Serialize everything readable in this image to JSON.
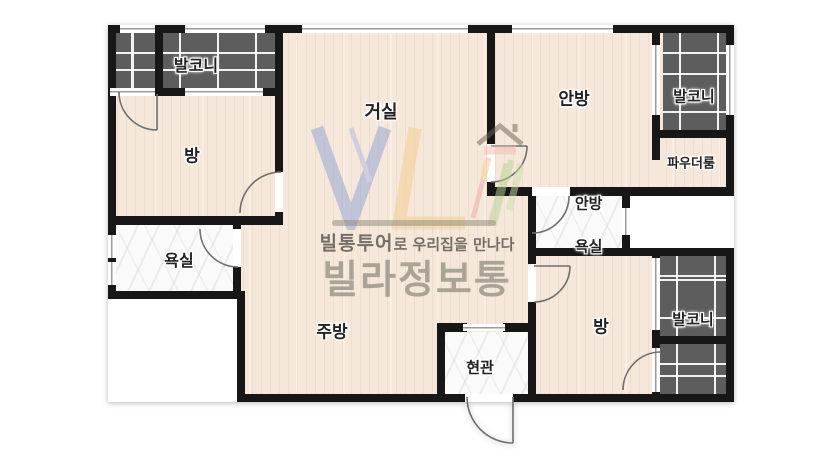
{
  "plan_title": "villa floor plan",
  "rooms": {
    "balcony_tl": "발코니",
    "room_left": "방",
    "living": "거실",
    "master": "안방",
    "balcony_tr": "발코니",
    "powder": "파우더룸",
    "master_bath_line1": "안방",
    "master_bath_line2": "욕실",
    "bath": "욕실",
    "kitchen": "주방",
    "entry": "현관",
    "room_br": "방",
    "balcony_br": "발코니"
  },
  "watermark": {
    "brand_bold": "빌통투어",
    "tagline_rest": "로 우리집을 만나다",
    "brand_large": "빌라정보통"
  },
  "colors": {
    "floor": "#f5e8da",
    "wall": "#171717",
    "balcony_tile": "#5e5d5d",
    "marble": "#fafafa",
    "logo_blue": "#b0bce1",
    "logo_yellow": "#f4cd8e",
    "logo_green": "#b9d48f",
    "logo_red": "#f0a8a2",
    "brand_gray": "#9e978c"
  }
}
